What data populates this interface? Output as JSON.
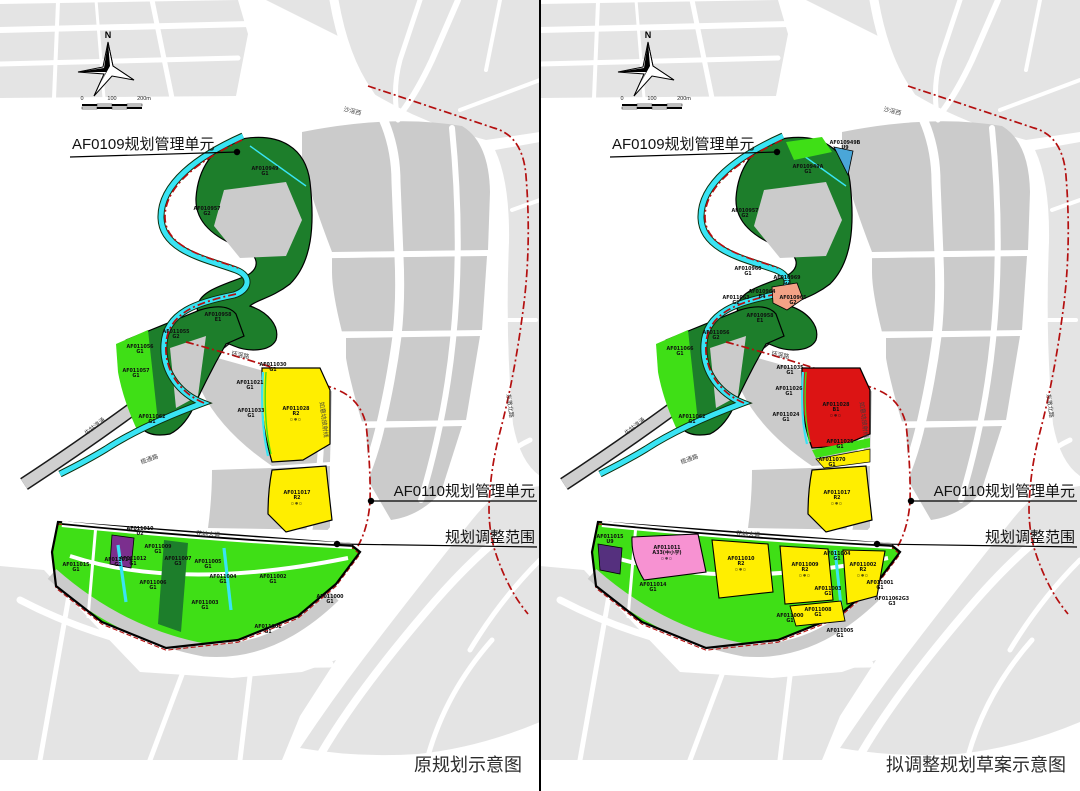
{
  "document": {
    "left_caption": "原规划示意图",
    "right_caption": "拟调整规划草案示意图"
  },
  "annotations": {
    "af0109_unit": "AF0109规划管理单元",
    "af0110_unit": "AF0110规划管理单元",
    "adjust_scope": "规划调整范围"
  },
  "compass": {
    "north": "N"
  },
  "scalebar": {
    "zero": "0",
    "mid": "100",
    "end": "200m"
  },
  "map": {
    "icon_row": "▫⊕▫"
  },
  "colors": {
    "gray_outside": "#e4e4e4",
    "gray_inside": "#cbcbcb",
    "road_gray": "#cfcfcf",
    "bright_green": "#3fdf16",
    "dark_green": "#1d7e2b",
    "water_cyan": "#39e4f4",
    "residential_yellow": "#ffee00",
    "commercial_red": "#dc1414",
    "boundary_red": "#b40f0f",
    "school_pink": "#f792d2",
    "salmon": "#f3a286",
    "utility_purple": "#7b2f8e",
    "utility_dark": "#55307e",
    "blue": "#4aa6d8"
  },
  "roads": [
    {
      "label": "牛牯湾涌",
      "x": 96,
      "y": 428,
      "rot": -38
    },
    {
      "label": "榄通路",
      "x": 150,
      "y": 461,
      "rot": -20
    },
    {
      "label": "环滘路",
      "x": 240,
      "y": 357,
      "rot": 11
    },
    {
      "label": "如意坊放射线",
      "x": 322,
      "y": 420,
      "rot": 83
    },
    {
      "label": "沙滘西",
      "x": 352,
      "y": 113,
      "rot": 14
    },
    {
      "label": "花地大道",
      "x": 208,
      "y": 536,
      "rot": 4
    },
    {
      "label": "东漖北路",
      "x": 508,
      "y": 406,
      "rot": 82
    }
  ],
  "left": {
    "parcels": [
      {
        "id": "AF010949",
        "code": "G1",
        "x": 265,
        "y": 170
      },
      {
        "id": "AF010957",
        "code": "G2",
        "x": 207,
        "y": 210
      },
      {
        "id": "AF010958",
        "code": "E1",
        "x": 218,
        "y": 316
      },
      {
        "id": "AF011055",
        "code": "G2",
        "x": 176,
        "y": 333
      },
      {
        "id": "AF011056",
        "code": "G1",
        "x": 140,
        "y": 348
      },
      {
        "id": "AF011057",
        "code": "G1",
        "x": 136,
        "y": 372
      },
      {
        "id": "AF011062",
        "code": "G1",
        "x": 152,
        "y": 418
      },
      {
        "id": "AF011030",
        "code": "G1",
        "x": 273,
        "y": 366
      },
      {
        "id": "AF011021",
        "code": "G1",
        "x": 250,
        "y": 384
      },
      {
        "id": "AF011033",
        "code": "G1",
        "x": 251,
        "y": 412
      },
      {
        "id": "AF011028",
        "code": "R2",
        "x": 296,
        "y": 410,
        "icons": true
      },
      {
        "id": "AF011017",
        "code": "R2",
        "x": 297,
        "y": 494,
        "icons": true
      },
      {
        "id": "AF011015",
        "code": "G1",
        "x": 76,
        "y": 566
      },
      {
        "id": "AF011014",
        "code": "G1",
        "x": 118,
        "y": 561
      },
      {
        "id": "AF011010",
        "code": "U2",
        "x": 140,
        "y": 530
      },
      {
        "id": "AF011009",
        "code": "G1",
        "x": 158,
        "y": 548
      },
      {
        "id": "AF011012",
        "code": "G1",
        "x": 133,
        "y": 560
      },
      {
        "id": "AF011007",
        "code": "G3",
        "x": 178,
        "y": 560
      },
      {
        "id": "AF011005",
        "code": "G1",
        "x": 208,
        "y": 563
      },
      {
        "id": "AF011006",
        "code": "G1",
        "x": 153,
        "y": 584
      },
      {
        "id": "AF011004",
        "code": "G1",
        "x": 223,
        "y": 578
      },
      {
        "id": "AF011002",
        "code": "G1",
        "x": 273,
        "y": 578
      },
      {
        "id": "AF011003",
        "code": "G1",
        "x": 205,
        "y": 604
      },
      {
        "id": "AF011001",
        "code": "G1",
        "x": 268,
        "y": 628
      },
      {
        "id": "AF011000",
        "code": "G1",
        "x": 330,
        "y": 598
      }
    ]
  },
  "right": {
    "parcels": [
      {
        "id": "AF010949A",
        "code": "G1",
        "x": 268,
        "y": 168
      },
      {
        "id": "AF010949B",
        "code": "U9",
        "x": 305,
        "y": 144
      },
      {
        "id": "AF010957",
        "code": "G2",
        "x": 205,
        "y": 212
      },
      {
        "id": "AF010960",
        "code": "G1",
        "x": 208,
        "y": 270
      },
      {
        "id": "AF010969",
        "code": "G2",
        "x": 247,
        "y": 279
      },
      {
        "id": "AF010964",
        "code": "B4",
        "x": 222,
        "y": 293
      },
      {
        "id": "AF011063",
        "code": "G2",
        "x": 196,
        "y": 299
      },
      {
        "id": "AF010965",
        "code": "G2",
        "x": 253,
        "y": 299
      },
      {
        "id": "AF010958",
        "code": "E1",
        "x": 220,
        "y": 317
      },
      {
        "id": "AF011056",
        "code": "G2",
        "x": 176,
        "y": 334
      },
      {
        "id": "AF011066",
        "code": "G1",
        "x": 140,
        "y": 350
      },
      {
        "id": "AF011062",
        "code": "G1",
        "x": 152,
        "y": 418
      },
      {
        "id": "AF011035",
        "code": "G1",
        "x": 250,
        "y": 369
      },
      {
        "id": "AF011026",
        "code": "G1",
        "x": 249,
        "y": 390
      },
      {
        "id": "AF011024",
        "code": "G1",
        "x": 246,
        "y": 416
      },
      {
        "id": "AF011028",
        "code": "B1",
        "x": 296,
        "y": 406,
        "icons": true
      },
      {
        "id": "AF011025",
        "code": "G1",
        "x": 300,
        "y": 443
      },
      {
        "id": "AF011070",
        "code": "G1",
        "x": 292,
        "y": 461
      },
      {
        "id": "AF011017",
        "code": "R2",
        "x": 297,
        "y": 494,
        "icons": true
      },
      {
        "id": "AF011015",
        "code": "U9",
        "x": 70,
        "y": 538
      },
      {
        "id": "AF011011",
        "code": "A33(中小学)",
        "x": 127,
        "y": 549,
        "icons": true
      },
      {
        "id": "AF011010",
        "code": "R2",
        "x": 201,
        "y": 560,
        "icons": true
      },
      {
        "id": "AF011009",
        "code": "R2",
        "x": 265,
        "y": 566,
        "icons": true
      },
      {
        "id": "AF011004",
        "code": "G1",
        "x": 297,
        "y": 555
      },
      {
        "id": "AF011002",
        "code": "R2",
        "x": 323,
        "y": 566,
        "icons": true
      },
      {
        "id": "AF011003",
        "code": "G1",
        "x": 288,
        "y": 590
      },
      {
        "id": "AF011001",
        "code": "G1",
        "x": 340,
        "y": 584
      },
      {
        "id": "AF011014",
        "code": "G1",
        "x": 113,
        "y": 586
      },
      {
        "id": "AF011008",
        "code": "G1",
        "x": 278,
        "y": 611
      },
      {
        "id": "AF011000",
        "code": "G1",
        "x": 250,
        "y": 617
      },
      {
        "id": "AF011005",
        "code": "G1",
        "x": 300,
        "y": 632
      },
      {
        "id": "AF011062G3",
        "code": "G3",
        "x": 352,
        "y": 600
      }
    ]
  }
}
